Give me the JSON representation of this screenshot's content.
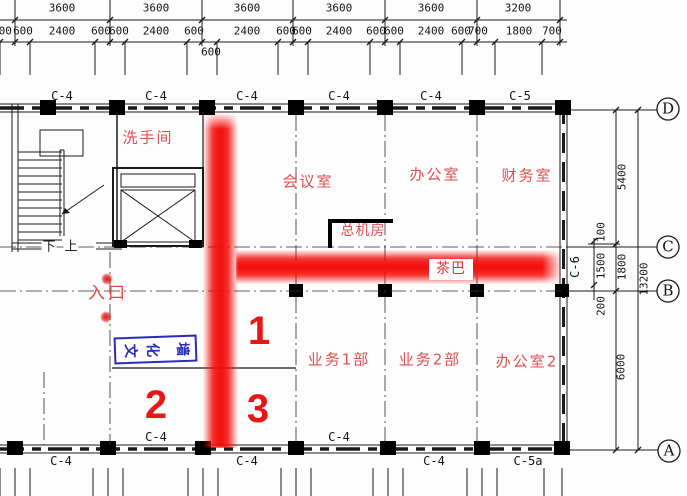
{
  "dims": {
    "top_row1": [
      "3600",
      "3600",
      "3600",
      "3600",
      "3600",
      "3200"
    ],
    "top_row2": [
      "600",
      "600",
      "2400",
      "600",
      "600",
      "2400",
      "600",
      "600",
      "2400",
      "600",
      "600",
      "2400",
      "600",
      "600",
      "2400",
      "600",
      "700",
      "1800",
      "700"
    ],
    "right": [
      "5400",
      "100",
      "1500",
      "1800",
      "200",
      "6000",
      "13200"
    ]
  },
  "grid": {
    "letters": [
      "D",
      "C",
      "B",
      "A"
    ]
  },
  "walls": {
    "top": [
      "C-4",
      "C-4",
      "C-4",
      "C-4",
      "C-4",
      "C-5"
    ],
    "bottom_above": [
      "C-4",
      "C-4"
    ],
    "bottom_below": [
      "C-4",
      "C-4",
      "C-4",
      "C-5a"
    ],
    "right": "C-6"
  },
  "rooms": {
    "restroom": "洗手间",
    "meeting": "会议室",
    "office": "办公室",
    "finance": "财务室",
    "switchboard": "总机房",
    "teabar": "茶巴",
    "sales1": "业务1部",
    "sales2": "业务2部",
    "office2": "办公室2"
  },
  "annotations": {
    "entrance": "入口",
    "culture_wall": "文化墙",
    "culture_wall_chars": [
      "文",
      "化",
      "墙"
    ],
    "num1": "1",
    "num2": "2",
    "num3": "3",
    "down": "下",
    "up": "上"
  },
  "colors": {
    "highlight_red": "#f20c08",
    "room_label_red": "#df5050",
    "annotation_blue": "#2a2ac0",
    "line_black": "#1a1a1a"
  }
}
